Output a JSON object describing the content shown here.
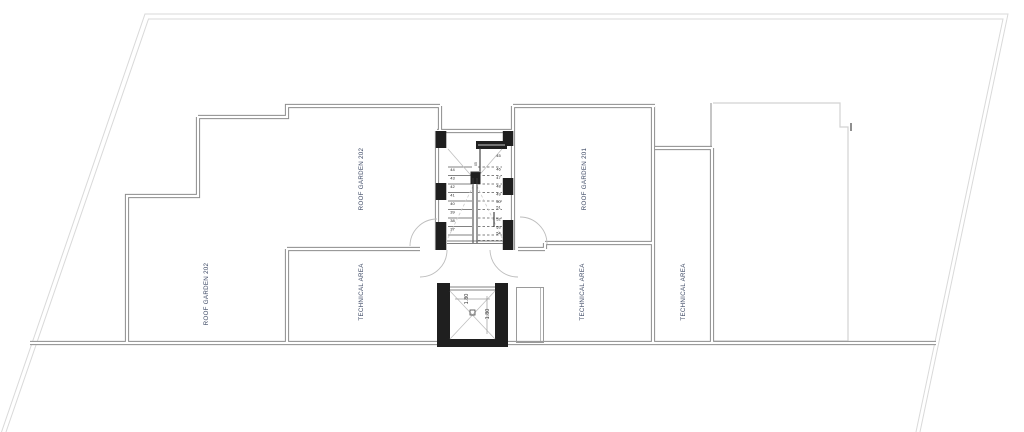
{
  "drawing": {
    "type": "architectural-roof-plan",
    "colors": {
      "background": "#ffffff",
      "site_boundary": "#d9d9d9",
      "neighbor_outline": "#d2d2d2",
      "wall": "#8c8c8c",
      "black_elements": "#1f1f1f",
      "label_text": "#3f4b66",
      "stair_text": "#222222"
    },
    "rooms": [
      {
        "label": "ROOF GARDEN 202"
      },
      {
        "label": "ROOF GARDEN 201"
      },
      {
        "label": "ROOF GARDEN 202"
      },
      {
        "label": "TECHNICAL AREA"
      },
      {
        "label": "TECHNICAL AREA"
      },
      {
        "label": "TECHNICAL AREA"
      }
    ],
    "stair": {
      "left_flight_steps": [
        "44",
        "43",
        "42",
        "41",
        "40",
        "39",
        "38",
        "37"
      ],
      "right_flight_steps": [
        "45",
        "46",
        "47",
        "48",
        "49",
        "50",
        "51",
        "52",
        "53",
        "54"
      ],
      "center_mark": "05"
    },
    "elevator": {
      "dimensions": [
        "1.80",
        "1.80"
      ]
    },
    "texts": [
      {
        "t": "ROOF GARDEN 202",
        "x": 363,
        "y": 179,
        "rot": -90,
        "size": 6.2,
        "color": "#3f4b66",
        "ls": 0.3,
        "kind": "room-label"
      },
      {
        "t": "ROOF GARDEN 201",
        "x": 586,
        "y": 179,
        "rot": -90,
        "size": 6.2,
        "color": "#3f4b66",
        "ls": 0.3,
        "kind": "room-label"
      },
      {
        "t": "ROOF GARDEN 202",
        "x": 208,
        "y": 294,
        "rot": -90,
        "size": 6.2,
        "color": "#3f4b66",
        "ls": 0.3,
        "kind": "room-label"
      },
      {
        "t": "TECHNICAL AREA",
        "x": 363,
        "y": 292,
        "rot": -90,
        "size": 6.2,
        "color": "#3f4b66",
        "ls": 0.3,
        "kind": "room-label"
      },
      {
        "t": "TECHNICAL AREA",
        "x": 584,
        "y": 292,
        "rot": -90,
        "size": 6.2,
        "color": "#3f4b66",
        "ls": 0.3,
        "kind": "room-label"
      },
      {
        "t": "TECHNICAL AREA",
        "x": 685,
        "y": 292,
        "rot": -90,
        "size": 6.2,
        "color": "#3f4b66",
        "ls": 0.3,
        "kind": "room-label"
      },
      {
        "t": "1.80",
        "x": 468,
        "y": 299,
        "rot": -90,
        "size": 5.5,
        "color": "#333333",
        "ls": 0,
        "kind": "dimension-label"
      },
      {
        "t": "1.80",
        "x": 489,
        "y": 314,
        "rot": -90,
        "size": 5.5,
        "color": "#333333",
        "ls": 0,
        "kind": "dimension-label"
      },
      {
        "t": "44",
        "x": 452.5,
        "y": 171,
        "rot": 0,
        "size": 4,
        "color": "#222222",
        "ls": 0,
        "kind": "stair-step-number"
      },
      {
        "t": "43",
        "x": 452.5,
        "y": 179.5,
        "rot": 0,
        "size": 4,
        "color": "#222222",
        "ls": 0,
        "kind": "stair-step-number"
      },
      {
        "t": "42",
        "x": 452.5,
        "y": 188,
        "rot": 0,
        "size": 4,
        "color": "#222222",
        "ls": 0,
        "kind": "stair-step-number"
      },
      {
        "t": "41",
        "x": 452.5,
        "y": 196.5,
        "rot": 0,
        "size": 4,
        "color": "#222222",
        "ls": 0,
        "kind": "stair-step-number"
      },
      {
        "t": "40",
        "x": 452.5,
        "y": 205,
        "rot": 0,
        "size": 4,
        "color": "#222222",
        "ls": 0,
        "kind": "stair-step-number"
      },
      {
        "t": "39",
        "x": 452.5,
        "y": 213.5,
        "rot": 0,
        "size": 4,
        "color": "#222222",
        "ls": 0,
        "kind": "stair-step-number"
      },
      {
        "t": "38",
        "x": 452.5,
        "y": 222,
        "rot": 0,
        "size": 4,
        "color": "#222222",
        "ls": 0,
        "kind": "stair-step-number"
      },
      {
        "t": "37",
        "x": 452.5,
        "y": 230.5,
        "rot": 0,
        "size": 4,
        "color": "#222222",
        "ls": 0,
        "kind": "stair-step-number"
      },
      {
        "t": "45",
        "x": 498.5,
        "y": 157,
        "rot": 0,
        "size": 4,
        "color": "#222222",
        "ls": 0,
        "kind": "stair-step-number"
      },
      {
        "t": "46",
        "x": 498.5,
        "y": 170.5,
        "rot": 0,
        "size": 4,
        "color": "#222222",
        "ls": 0,
        "kind": "stair-step-number"
      },
      {
        "t": "47",
        "x": 498.5,
        "y": 179,
        "rot": 0,
        "size": 4,
        "color": "#222222",
        "ls": 0,
        "kind": "stair-step-number"
      },
      {
        "t": "48",
        "x": 498.5,
        "y": 187.5,
        "rot": 0,
        "size": 4,
        "color": "#222222",
        "ls": 0,
        "kind": "stair-step-number"
      },
      {
        "t": "49",
        "x": 498.5,
        "y": 195.5,
        "rot": 0,
        "size": 4,
        "color": "#222222",
        "ls": 0,
        "kind": "stair-step-number"
      },
      {
        "t": "50",
        "x": 498.5,
        "y": 203,
        "rot": 0,
        "size": 4,
        "color": "#222222",
        "ls": 0,
        "kind": "stair-step-number"
      },
      {
        "t": "51",
        "x": 498.5,
        "y": 208.5,
        "rot": 0,
        "size": 4,
        "color": "#222222",
        "ls": 0,
        "kind": "stair-step-number"
      },
      {
        "t": "52",
        "x": 498.5,
        "y": 220.5,
        "rot": 0,
        "size": 4,
        "color": "#222222",
        "ls": 0,
        "kind": "stair-step-number"
      },
      {
        "t": "53",
        "x": 498.5,
        "y": 228.5,
        "rot": 0,
        "size": 4,
        "color": "#222222",
        "ls": 0,
        "kind": "stair-step-number"
      },
      {
        "t": "54",
        "x": 498.5,
        "y": 234.5,
        "rot": 0,
        "size": 4,
        "color": "#222222",
        "ls": 0,
        "kind": "stair-step-number"
      },
      {
        "t": "05",
        "x": 477,
        "y": 164,
        "rot": -90,
        "size": 3.5,
        "color": "#333333",
        "ls": 0,
        "kind": "stair-direction-mark"
      }
    ]
  }
}
